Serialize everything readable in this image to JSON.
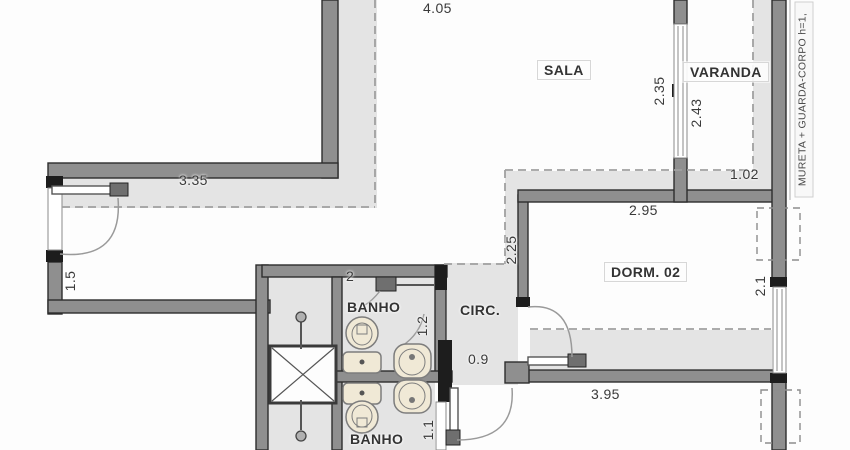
{
  "plan": {
    "rooms": {
      "sala": "SALA",
      "varanda": "VARANDA",
      "dorm02": "DORM. 02",
      "circ": "CIRC.",
      "banho1": "BANHO",
      "banho2": "BANHO"
    },
    "dims": {
      "sala_top": "4.05",
      "hall_width": "3.35",
      "hall_depth": "1.5",
      "sala_varanda_opening": "2.35",
      "varanda_depth": "2.43",
      "varanda_width": "1.02",
      "dorm_width": "2.95",
      "dorm_depth": "2.1",
      "circ_length": "2.25",
      "banho_width": "2",
      "banho1_depth": "1.2",
      "banho2_depth": "1.1",
      "circ_door": "0.9",
      "dorm_bottom": "3.95"
    },
    "notes": {
      "guardrail": "MURETA + GUARDA-CORPO h=1,"
    },
    "colors": {
      "wall": "#8f8f8f",
      "wall_edge": "#2d2d2d",
      "cap": "#1d1d1d",
      "hatch": "#e4e4e4",
      "fixture": "#f0e9d6",
      "dash": "#a0a0a0"
    }
  }
}
